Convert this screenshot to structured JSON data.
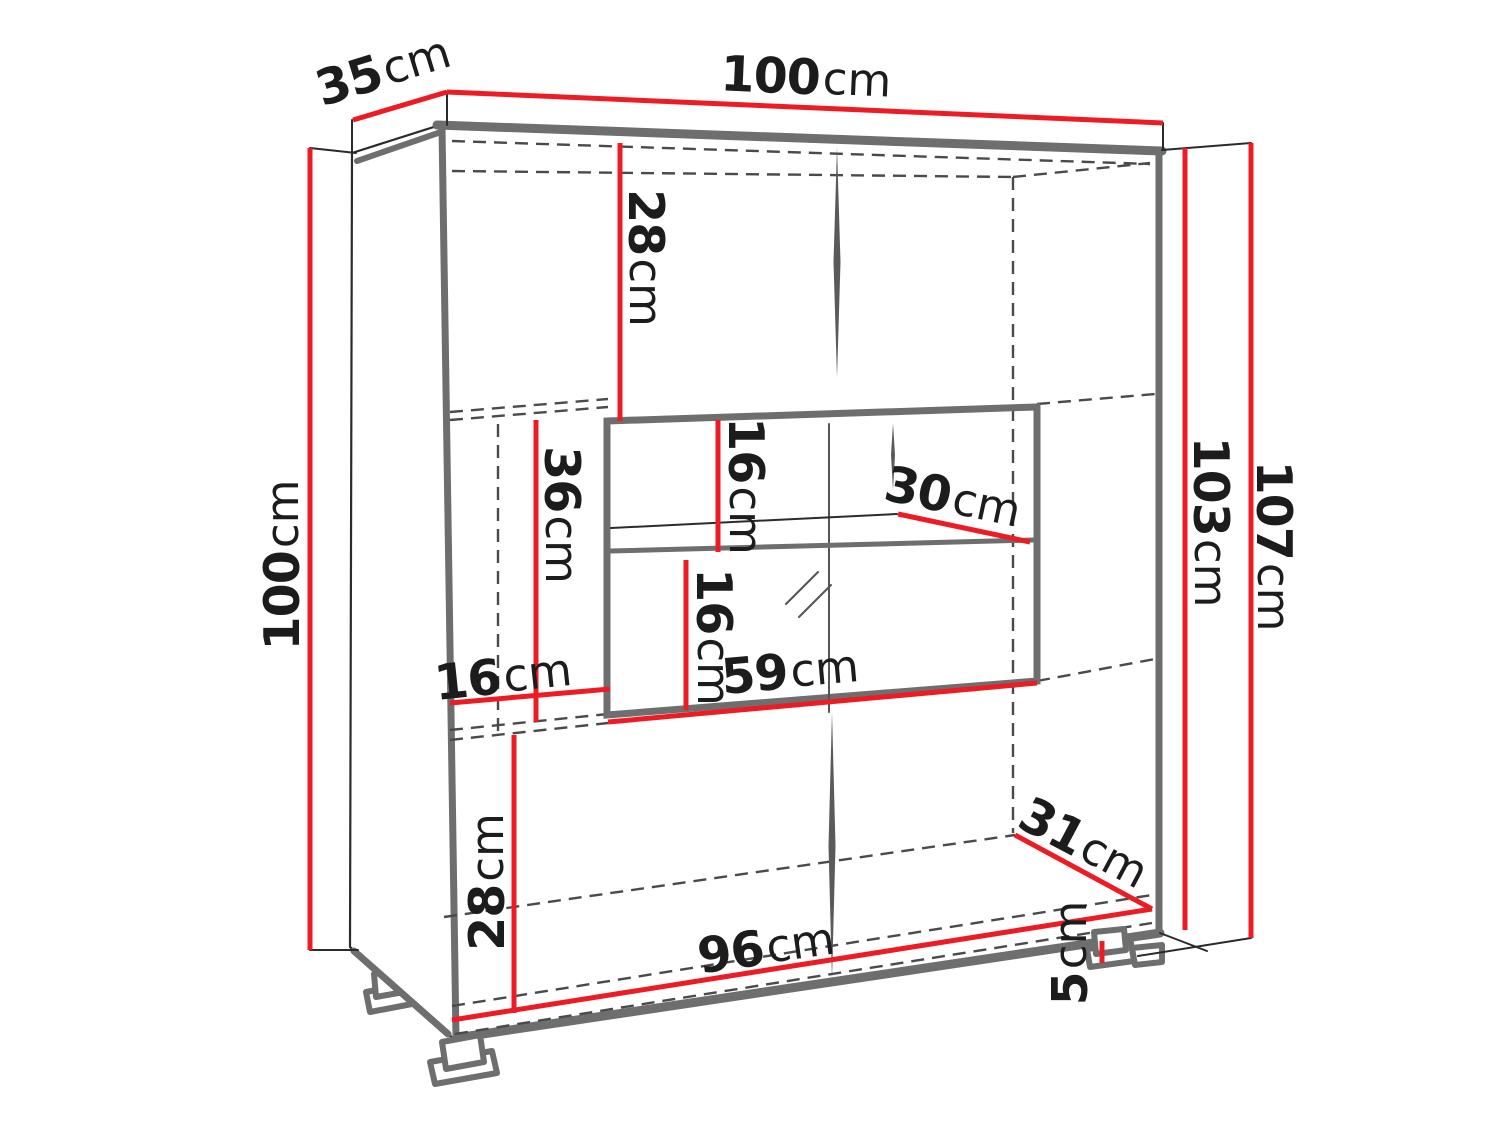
{
  "diagram": {
    "type": "furniture-dimension-diagram",
    "subject": "display cabinet with glass showcase compartment and legs",
    "units": "cm",
    "colors": {
      "dimension_red": "#ed1c24",
      "edge_gray": "#6e6e6e",
      "outline_black": "#2b2b2b",
      "hidden_dash_gray": "#4a4a4a",
      "text": "#1c1c1c",
      "background": "#ffffff"
    },
    "labels": {
      "depth_top": {
        "value": "35",
        "unit": "cm"
      },
      "width_top": {
        "value": "100",
        "unit": "cm"
      },
      "height_left": {
        "value": "100",
        "unit": "cm"
      },
      "height_inner_right": {
        "value": "103",
        "unit": "cm"
      },
      "height_outer_right": {
        "value": "107",
        "unit": "cm"
      },
      "top_section_height": {
        "value": "28",
        "unit": "cm"
      },
      "middle_left_height": {
        "value": "36",
        "unit": "cm"
      },
      "left_niche_width": {
        "value": "16",
        "unit": "cm"
      },
      "glass_upper_height": {
        "value": "16",
        "unit": "cm"
      },
      "glass_lower_height": {
        "value": "16",
        "unit": "cm"
      },
      "glass_shelf_depth": {
        "value": "30",
        "unit": "cm"
      },
      "glass_width": {
        "value": "59",
        "unit": "cm"
      },
      "bottom_section_height": {
        "value": "28",
        "unit": "cm"
      },
      "inner_bottom_width": {
        "value": "96",
        "unit": "cm"
      },
      "inner_bottom_depth": {
        "value": "31",
        "unit": "cm"
      },
      "leg_height": {
        "value": "5",
        "unit": "cm"
      }
    }
  }
}
